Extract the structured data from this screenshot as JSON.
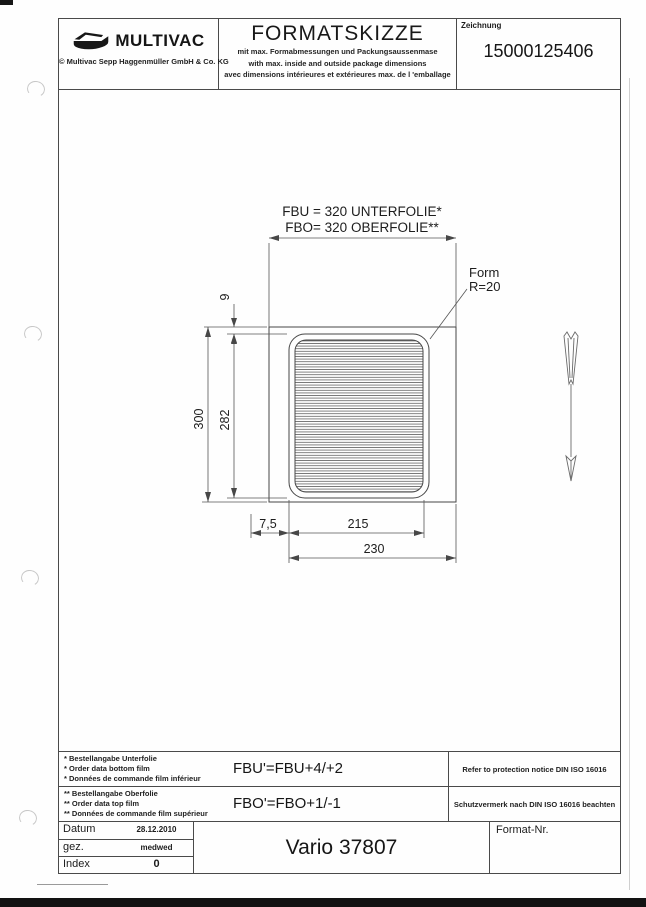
{
  "header": {
    "logo": {
      "brand": "MULTIVAC",
      "copyright": "© Multivac Sepp Haggenmüller GmbH & Co. KG"
    },
    "title": "FORMATSKIZZE",
    "subtitles": [
      "mit max. Formabmessungen und Packungsaussenmase",
      "with max. inside and outside package dimensions",
      "avec dimensions intérieures et extérieures max. de l 'emballage"
    ],
    "drawing_field": {
      "label": "Zeichnung",
      "number": "15000125406"
    }
  },
  "drawing": {
    "film_label_unterfolie": "FBU = 320 UNTERFOLIE*",
    "film_label_oberfolie": "FBO= 320 OBERFOLIE**",
    "form_label": "Form",
    "form_radius": "R=20",
    "dim_height_outer": "300",
    "dim_height_inner": "282",
    "dim_top_offset": "9",
    "dim_left_offset": "7,5",
    "dim_width_inner": "215",
    "dim_width_outer": "230"
  },
  "notes": {
    "rows": [
      {
        "lines": [
          "* Bestellangabe Unterfolie",
          "* Order data bottom film",
          "* Données de commande film inférieur"
        ],
        "formula": "FBU'=FBU+4/+2",
        "notice": "Refer to protection notice DIN ISO 16016"
      },
      {
        "lines": [
          "** Bestellangabe Oberfolie",
          "** Order data top film",
          "** Données de commande film supérieur"
        ],
        "formula": "FBO'=FBO+1/-1",
        "notice": "Schutzvermerk nach DIN ISO 16016 beachten"
      }
    ]
  },
  "title_block": {
    "rows": [
      {
        "label": "Datum",
        "value": "28.12.2010"
      },
      {
        "label": "gez.",
        "value": "medwed"
      },
      {
        "label": "Index",
        "value": "0"
      }
    ],
    "machine": "Vario 37807",
    "format_label": "Format-Nr."
  }
}
